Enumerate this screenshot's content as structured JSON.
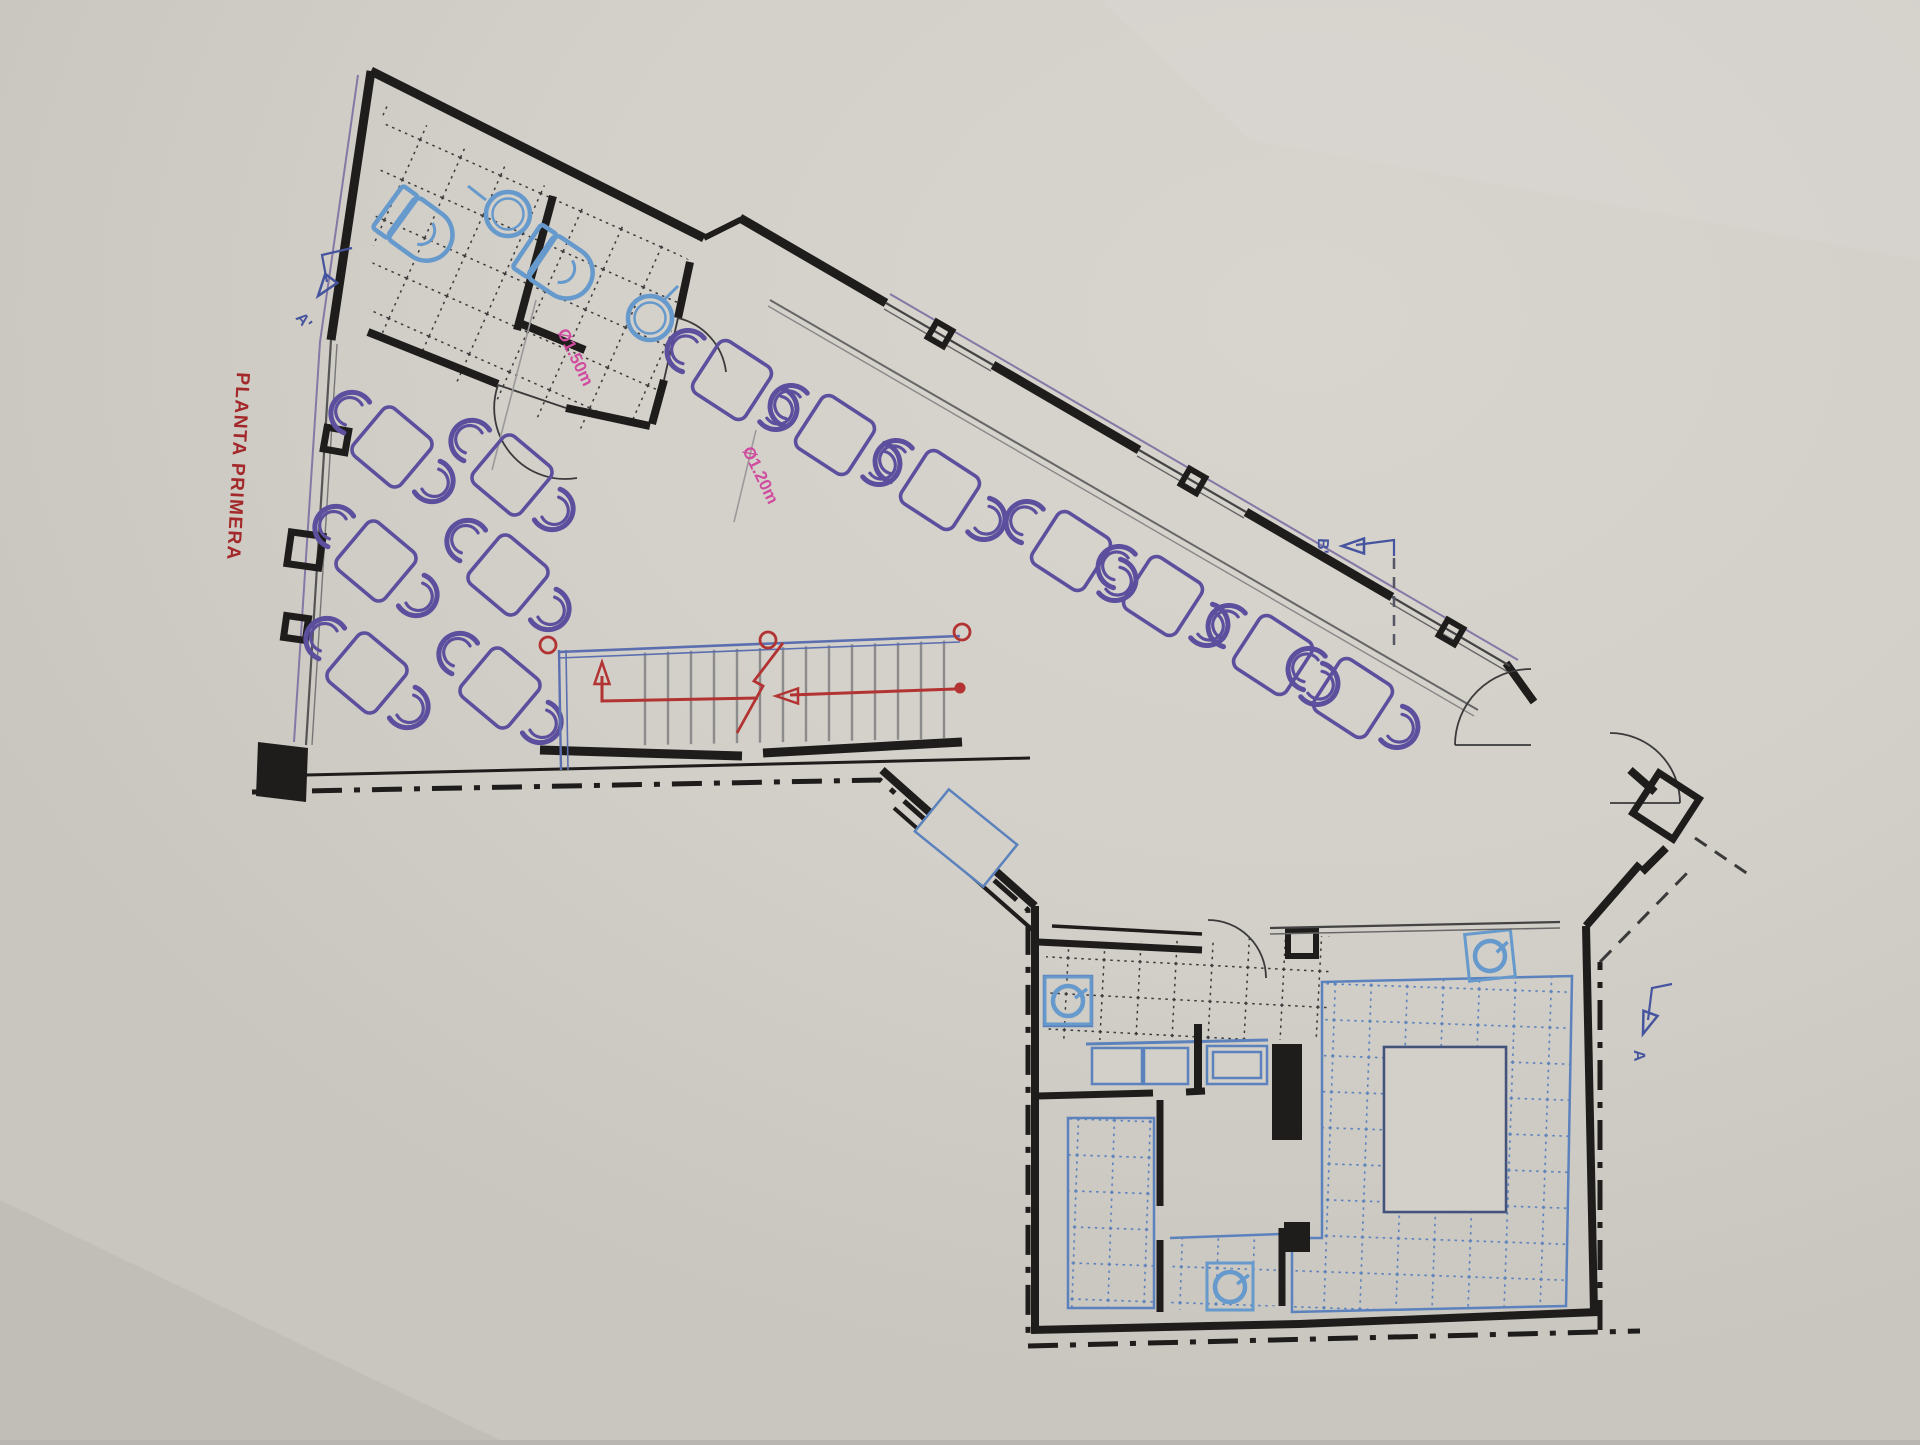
{
  "plan": {
    "title": "PLANTA PRIMERA",
    "dimensions": {
      "large_circle": "Ø1.50m",
      "small_circle": "Ø1.20m"
    },
    "section_markers": {
      "a_prime": "A'",
      "b_prime": "B'",
      "a": "A"
    }
  },
  "colors": {
    "paper": "#d3cfc9",
    "wall_black": "#1f1d1c",
    "furniture_purple": "#5c4f9e",
    "fixture_blue": "#6699cc",
    "tile_blue": "#5b82bd",
    "stairs_rail_blue": "#5b6fb0",
    "stairs_arrow_red": "#b23331",
    "title_red": "#a3282a",
    "dimension_pink": "#cf4c9f",
    "section_marker_blue": "#45549f",
    "window_purple": "#8678a6",
    "tread_gray": "#8c8c8c"
  },
  "furniture": {
    "left_group_tables": 6,
    "corridor_row_tables": 7,
    "chairs_per_table": 2,
    "toilets": 2,
    "round_sinks": 2,
    "kitchen_equipment_symbols": 3
  }
}
